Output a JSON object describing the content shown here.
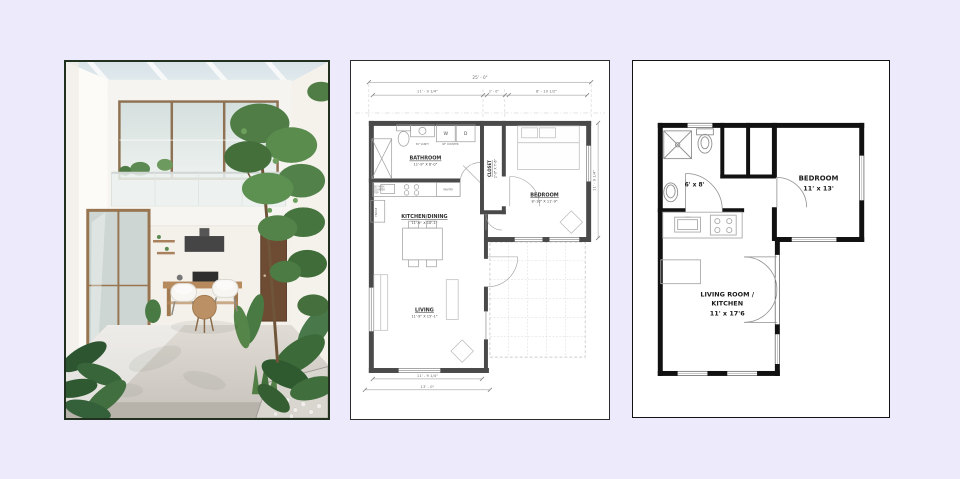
{
  "page": {
    "background": "#edeafc"
  },
  "panels": {
    "photo": {
      "alt": "interior-courtyard-photo"
    },
    "plan_detailed": {
      "dims": {
        "overall_width": "25' - 0\"",
        "top_left": "11' - 9 1/4\"",
        "top_mid": "2' - 0\"",
        "top_right": "8' - 10 1/2\"",
        "right_side": "11' - 9 1/4\"",
        "bottom_inner": "11' - 9 1/4\"",
        "bottom_outer": "13' - 0\""
      },
      "rooms": {
        "bathroom_name": "BATHROOM",
        "bathroom_size": "11'-9\" X 6'-0\"",
        "closet_name": "CLOSET",
        "closet_size": "2'-0\" X 7'-6\"",
        "bedroom_name": "BEDROOM",
        "bedroom_size": "8'-10\" X 11'-9\"",
        "kitchen_name": "KITCHEN/DINING",
        "kitchen_size": "11'-9\" X 10'-1\"",
        "living_name": "LIVING",
        "living_size": "11'-9\" X 15'-1\""
      },
      "labels": {
        "washer": "W",
        "dryer": "D",
        "vanity": "36\" VANITY",
        "counter": "48\" COUNTER",
        "pantry": "PANTRY",
        "counter_top_1": "36\" HIGH",
        "counter_top_2": "COUNTER",
        "counter_top_3": "TOP",
        "fridge": "FRIDGE"
      }
    },
    "plan_simple": {
      "rooms": {
        "bathroom_size": "6' x 8'",
        "bedroom_name": "BEDROOM",
        "bedroom_size": "11' x 13'",
        "living_line1": "LIVING ROOM /",
        "living_line2": "KITCHEN",
        "living_size": "11' x 17'6"
      }
    }
  }
}
